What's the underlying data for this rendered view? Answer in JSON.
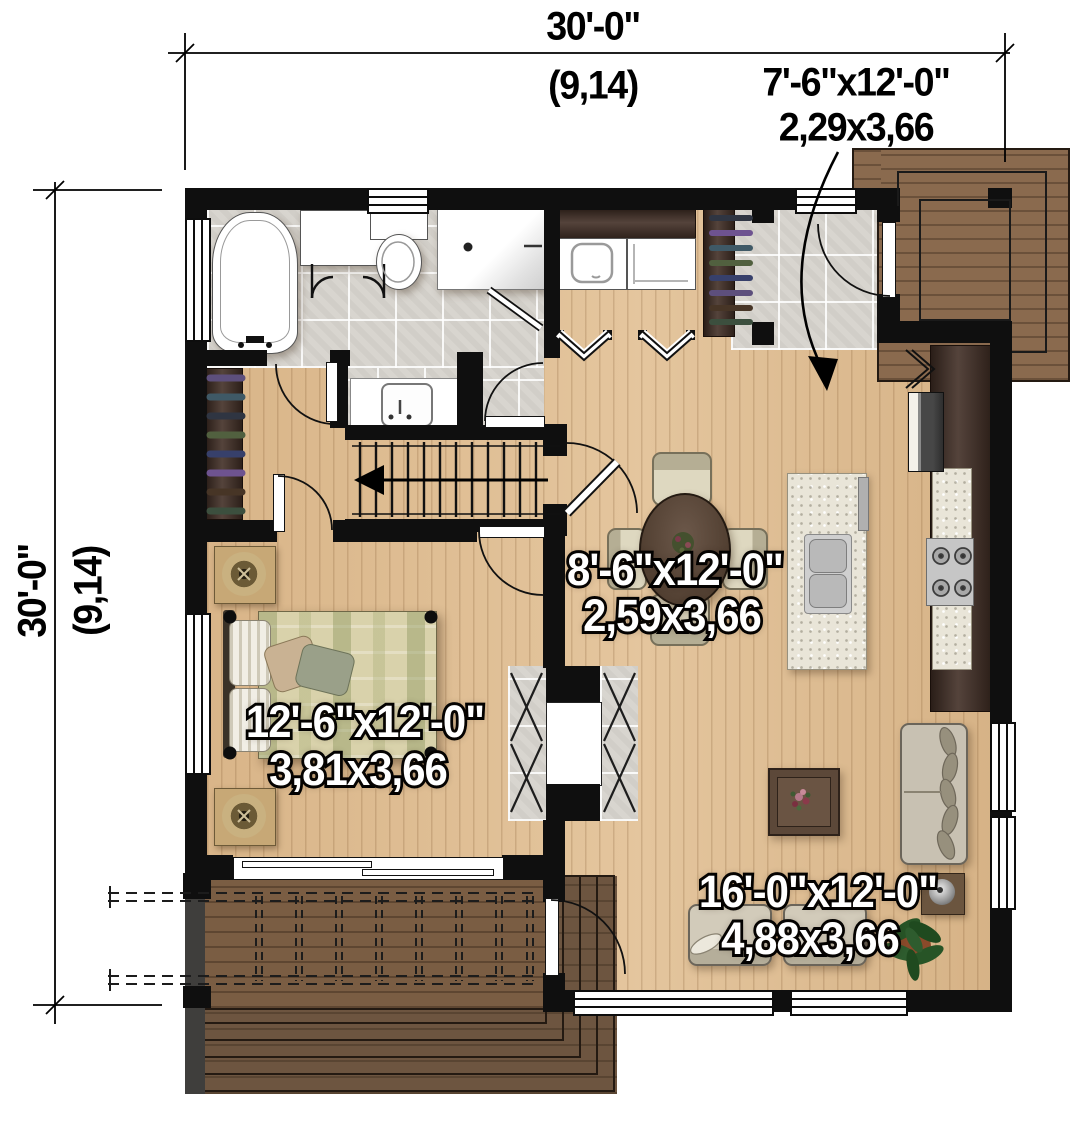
{
  "drawing": {
    "type": "architectural-floor-plan",
    "dimensions": {
      "top": {
        "imperial": "30'-0\"",
        "metric": "(9,14)"
      },
      "left": {
        "imperial": "30'-0\"",
        "metric": "(9,14)"
      }
    },
    "callout": {
      "balcony": {
        "imperial": "7'-6\"x12'-0\"",
        "metric": "2,29x3,66"
      }
    },
    "rooms": {
      "dining": {
        "imperial": "8'-6\"x12'-0\"",
        "metric": "2,59x3,66"
      },
      "bedroom": {
        "imperial": "12'-6\"x12'-0\"",
        "metric": "3,81x3,66"
      },
      "living": {
        "imperial": "16'-0\"x12'-0\"",
        "metric": "4,88x3,66"
      }
    },
    "colors": {
      "wall": "#0f0f0f",
      "wood_floor": "#debc92",
      "tile_floor": "#d8d5cf",
      "deck_wood": "#7a5d43",
      "balcony_wood": "#8a6a4e",
      "dark_cabinet": "#412e25",
      "granite": "#e9e5d8",
      "label_fill": "#ffffff",
      "label_stroke": "#000000",
      "dimension_text": "#000000"
    }
  }
}
